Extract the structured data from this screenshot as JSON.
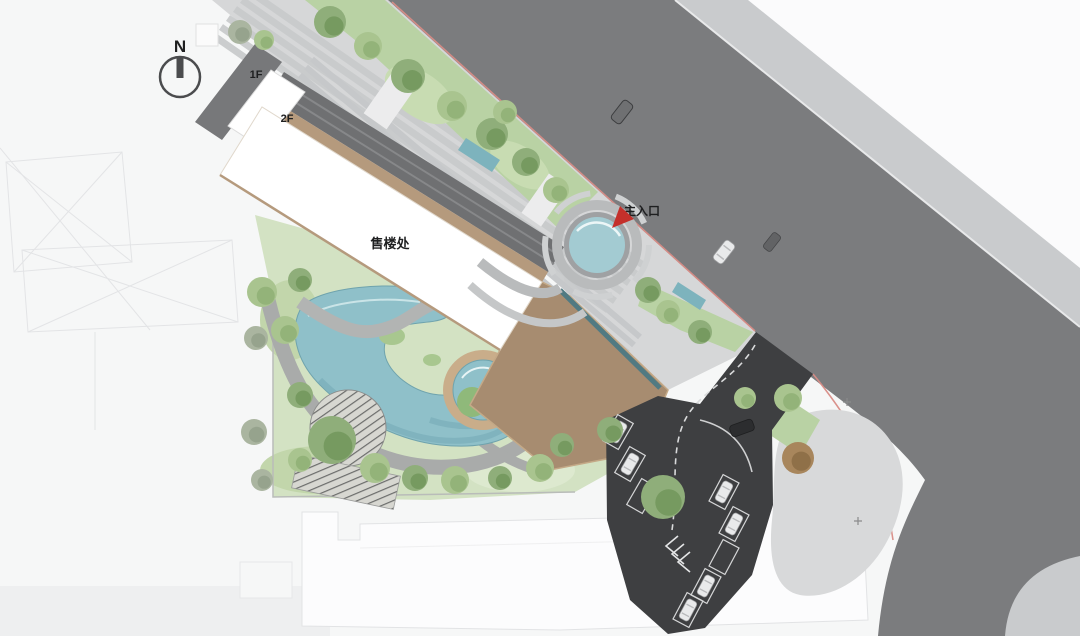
{
  "plan": {
    "title": "售楼处 sales-center landscape site plan",
    "north_label": "N",
    "labels": {
      "floor1": "1F",
      "floor2": "2F",
      "building": "售楼处",
      "main_entrance": "主入口"
    }
  },
  "colors": {
    "background": "#f6f7f7",
    "main_road": "#7b7c7e",
    "sidewalk": "#c9cbcd",
    "parking_asphalt": "#3e3f41",
    "water": "#8fc0c9",
    "entrance_pool_water": "#a3cbd2",
    "wood_deck": "#a78c70",
    "roof_trim": "#b59a7d",
    "canopy": "#6f7072",
    "lawn": "#d3e2c3",
    "green_belt": "#b9d2a4",
    "tree_green": "#7fa96d",
    "entrance_marker_red": "#c4302b",
    "boundary_red_line": "#d88c86"
  }
}
